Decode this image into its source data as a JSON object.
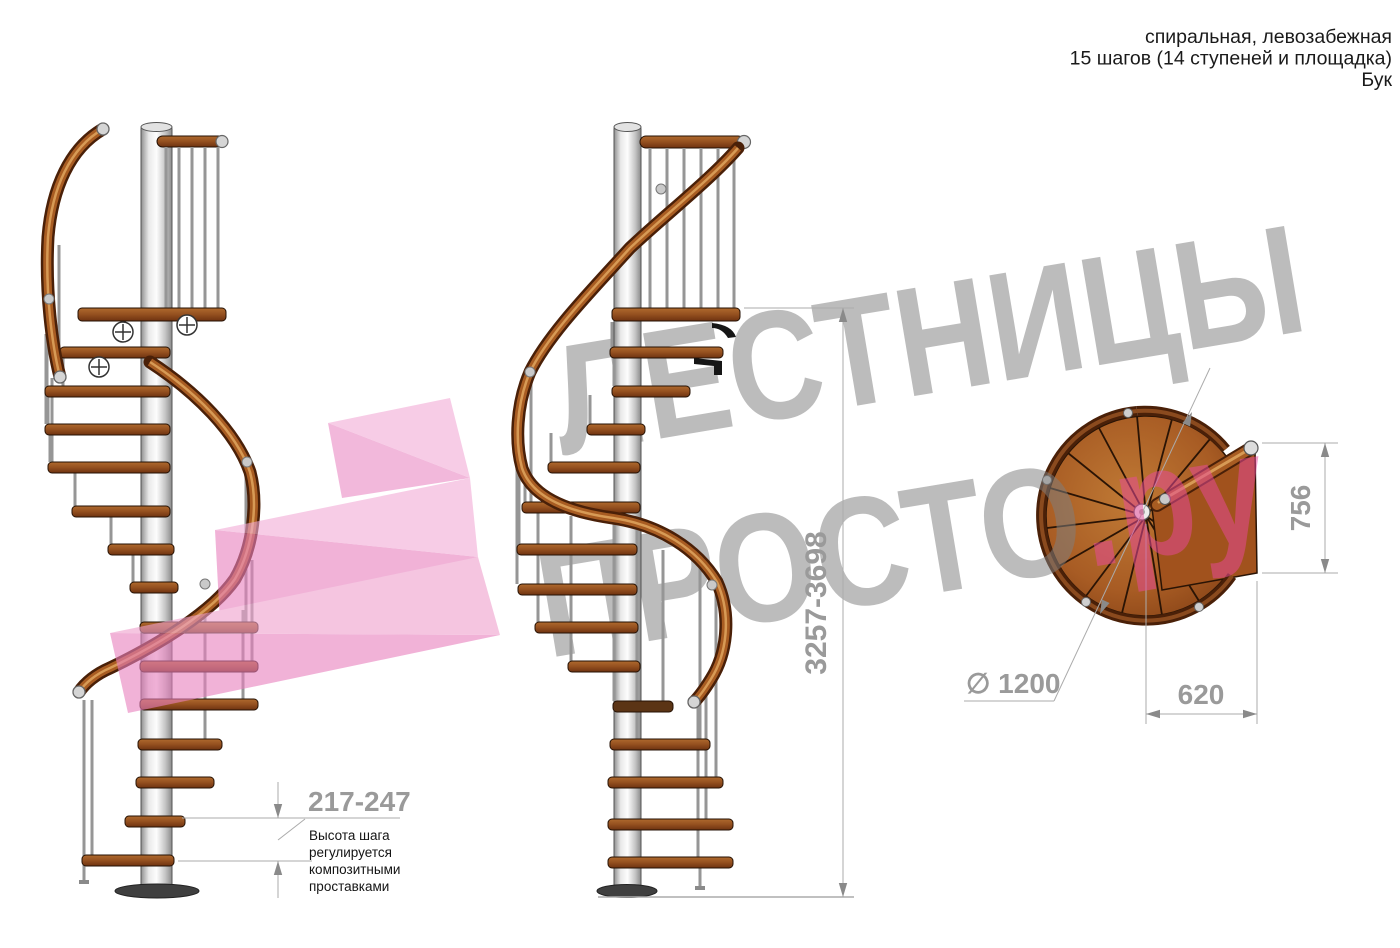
{
  "header": {
    "line1": "спиральная, левозабежная",
    "line2": "15 шагов (14 ступеней и площадка)",
    "line3": "Бук"
  },
  "watermark": {
    "line1": "ЛЕСТНИЦЫ",
    "line2_gray": "ПРОСТО",
    "line2_pink": ".ру"
  },
  "dimensions": {
    "step_height": "217-247",
    "total_height": "3257-3698",
    "diameter": "∅ 1200",
    "landing_depth": "756",
    "landing_width": "620"
  },
  "note": {
    "line1": "Высота шага",
    "line2": "регулируется",
    "line3": "композитными",
    "line4": "проставками"
  },
  "colors": {
    "dimension_gray": "#9a9a9a",
    "dimension_line": "#ababab",
    "watermark_gray": "#7f7f7f",
    "watermark_pink": "#e84a9b",
    "header_text": "#1a1a1a",
    "note_text": "#141414",
    "wood": "#8a4a1d",
    "rail_copper": "#a85c22",
    "column_silver": "#d9d9d9"
  }
}
